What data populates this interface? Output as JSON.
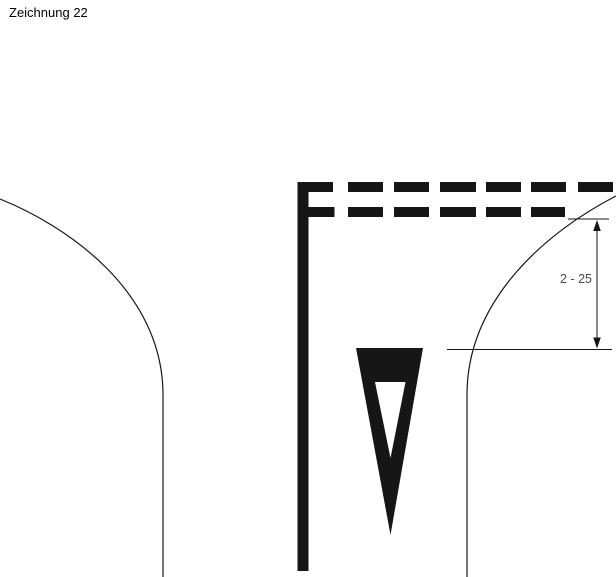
{
  "page": {
    "title": "Zeichnung 22",
    "background": "#ffffff"
  },
  "drawing": {
    "colors": {
      "ink": "#161616",
      "dimension_text": "#4c4c4c"
    },
    "dimension": {
      "label": "2 - 25"
    },
    "lane_marking": {
      "dash_rows": 2,
      "top_row_dash_count": 7,
      "bottom_row_dash_count": 6
    }
  }
}
